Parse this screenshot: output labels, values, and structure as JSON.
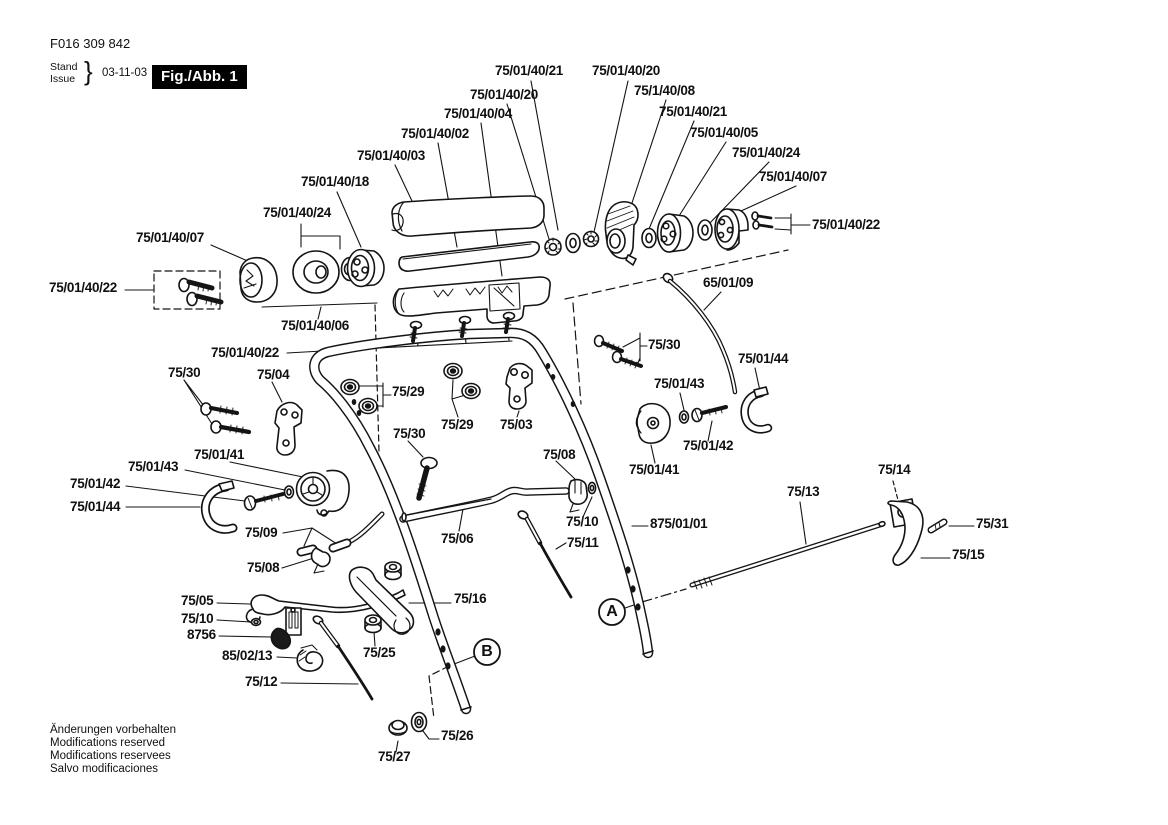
{
  "header": {
    "document_number": "F016 309 842",
    "revision_label_de": "Stand",
    "revision_label_en": "Issue",
    "brace": "}",
    "revision_date": "03-11-03",
    "figure_label": "Fig./Abb. 1"
  },
  "footer": {
    "line1": "Änderungen vorbehalten",
    "line2": "Modifications reserved",
    "line3": "Modifications reservees",
    "line4": "Salvo modificaciones"
  },
  "view_markers": {
    "a": "A",
    "b": "B"
  },
  "callouts": [
    {
      "id": "c00",
      "text": "75/01/40/21"
    },
    {
      "id": "c01",
      "text": "75/01/40/20"
    },
    {
      "id": "c02",
      "text": "75/01/40/20"
    },
    {
      "id": "c03",
      "text": "75/1/40/08"
    },
    {
      "id": "c04",
      "text": "75/01/40/04"
    },
    {
      "id": "c05",
      "text": "75/01/40/21"
    },
    {
      "id": "c06",
      "text": "75/01/40/02"
    },
    {
      "id": "c07",
      "text": "75/01/40/05"
    },
    {
      "id": "c08",
      "text": "75/01/40/03"
    },
    {
      "id": "c09",
      "text": "75/01/40/24"
    },
    {
      "id": "c10",
      "text": "75/01/40/18"
    },
    {
      "id": "c11",
      "text": "75/01/40/07"
    },
    {
      "id": "c12",
      "text": "75/01/40/24"
    },
    {
      "id": "c13",
      "text": "75/01/40/22"
    },
    {
      "id": "c14",
      "text": "75/01/40/07"
    },
    {
      "id": "c15",
      "text": "75/01/40/22"
    },
    {
      "id": "c16",
      "text": "65/01/09"
    },
    {
      "id": "c17",
      "text": "75/01/40/06"
    },
    {
      "id": "c18",
      "text": "75/01/40/22"
    },
    {
      "id": "c19",
      "text": "75/30"
    },
    {
      "id": "c20",
      "text": "75/01/44"
    },
    {
      "id": "c21",
      "text": "75/30"
    },
    {
      "id": "c22",
      "text": "75/04"
    },
    {
      "id": "c23",
      "text": "75/29"
    },
    {
      "id": "c24",
      "text": "75/01/43"
    },
    {
      "id": "c25",
      "text": "75/29"
    },
    {
      "id": "c26",
      "text": "75/03"
    },
    {
      "id": "c27",
      "text": "75/30"
    },
    {
      "id": "c28",
      "text": "75/08"
    },
    {
      "id": "c29",
      "text": "75/01/41"
    },
    {
      "id": "c30",
      "text": "75/01/42"
    },
    {
      "id": "c31",
      "text": "75/01/43"
    },
    {
      "id": "c32",
      "text": "75/01/41"
    },
    {
      "id": "c33",
      "text": "75/14"
    },
    {
      "id": "c34",
      "text": "75/01/42"
    },
    {
      "id": "c35",
      "text": "75/13"
    },
    {
      "id": "c36",
      "text": "75/01/44"
    },
    {
      "id": "c37",
      "text": "875/01/01"
    },
    {
      "id": "c38",
      "text": "75/10"
    },
    {
      "id": "c39",
      "text": "75/31"
    },
    {
      "id": "c40",
      "text": "75/09"
    },
    {
      "id": "c41",
      "text": "75/06"
    },
    {
      "id": "c42",
      "text": "75/11"
    },
    {
      "id": "c43",
      "text": "75/15"
    },
    {
      "id": "c44",
      "text": "75/08"
    },
    {
      "id": "c45",
      "text": "75/05"
    },
    {
      "id": "c46",
      "text": "75/16"
    },
    {
      "id": "c47",
      "text": "75/10"
    },
    {
      "id": "c48",
      "text": "8756"
    },
    {
      "id": "c49",
      "text": "85/02/13"
    },
    {
      "id": "c50",
      "text": "75/25"
    },
    {
      "id": "c51",
      "text": "75/12"
    },
    {
      "id": "c52",
      "text": "75/26"
    },
    {
      "id": "c53",
      "text": "75/27"
    }
  ]
}
